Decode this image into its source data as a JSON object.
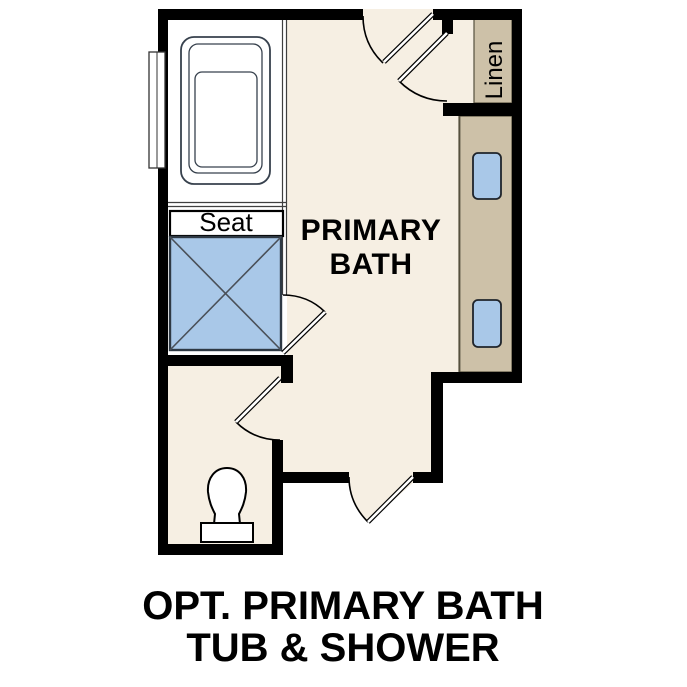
{
  "palette": {
    "color-wall": "#000000",
    "color-floor": "#f6efe3",
    "color-cabinet": "#cdc1a8",
    "color-fixture": "#a9c8e8",
    "color-fixline": "#37414d",
    "color-text": "#000000"
  },
  "plan": {
    "room_label_line1": "PRIMARY",
    "room_label_line2": "BATH",
    "seat_label": "Seat",
    "linen_label": "Linen",
    "fixtures": [
      "bathtub",
      "shower-with-seat",
      "toilet",
      "vanity-two-sinks",
      "linen-closet",
      "window"
    ]
  },
  "caption": {
    "line1": "OPT. PRIMARY BATH",
    "line2": "TUB & SHOWER"
  }
}
